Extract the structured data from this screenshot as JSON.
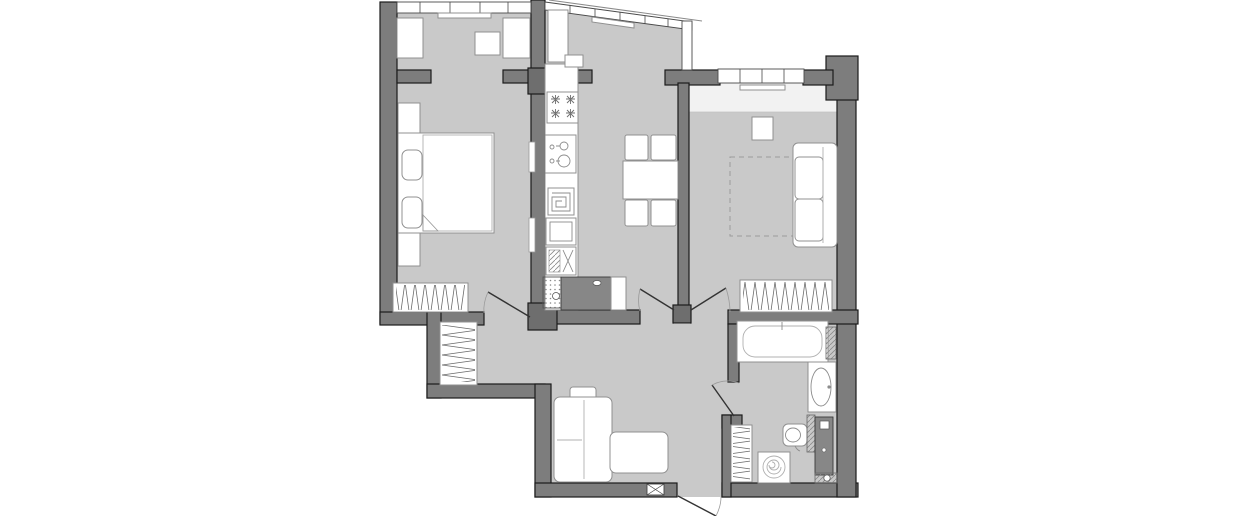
{
  "palette": {
    "background": "#ffffff",
    "floor": "#c9c9c9",
    "wall": "#7d7d7d",
    "wall_stroke": "#1b1b1b",
    "furniture_fill": "#ffffff",
    "furniture_stroke": "#909090",
    "dark_fixture": "#878787",
    "door_line": "#333333",
    "arc_line": "#9a9a9a",
    "dash_line": "#9a9a9a",
    "pattern_line": "#6a6a6a"
  },
  "drawing": {
    "kind": "apartment-floor-plan",
    "rooms": [
      {
        "name": "bedroom",
        "fixtures": [
          "window-band",
          "curtain-rail",
          "wardrobe-units",
          "nightstand",
          "double-bed",
          "pillows",
          "blanket-fold",
          "hanger-wardrobe",
          "wall-radiator"
        ]
      },
      {
        "name": "kitchen",
        "fixtures": [
          "angled-glazing",
          "tall-cabinet",
          "counter-run",
          "hob-4-burners",
          "sink-double",
          "spiral-appliance",
          "oven",
          "dishwasher",
          "vent-shaft",
          "dark-counter-peninsula",
          "dining-table",
          "chairs-x4"
        ]
      },
      {
        "name": "living-room",
        "fixtures": [
          "window-band",
          "curtain-rail",
          "window-sill",
          "side-table",
          "dashed-rug",
          "sofa",
          "hanger-wardrobe"
        ]
      },
      {
        "name": "hallway-entry",
        "fixtures": [
          "hanger-wardrobe",
          "corner-sofa",
          "cushion",
          "entrance-door",
          "door-box-symbol"
        ]
      },
      {
        "name": "bathroom",
        "fixtures": [
          "bathtub",
          "faucet",
          "washbasin-counter",
          "basin-oval",
          "toilet",
          "washing-machine-spiral",
          "towel-radiator",
          "plumbing-shaft",
          "hatched-ducts"
        ]
      }
    ],
    "doors": [
      "bedroom-door",
      "kitchen-door",
      "living-room-door",
      "bathroom-door",
      "entrance-door"
    ]
  }
}
